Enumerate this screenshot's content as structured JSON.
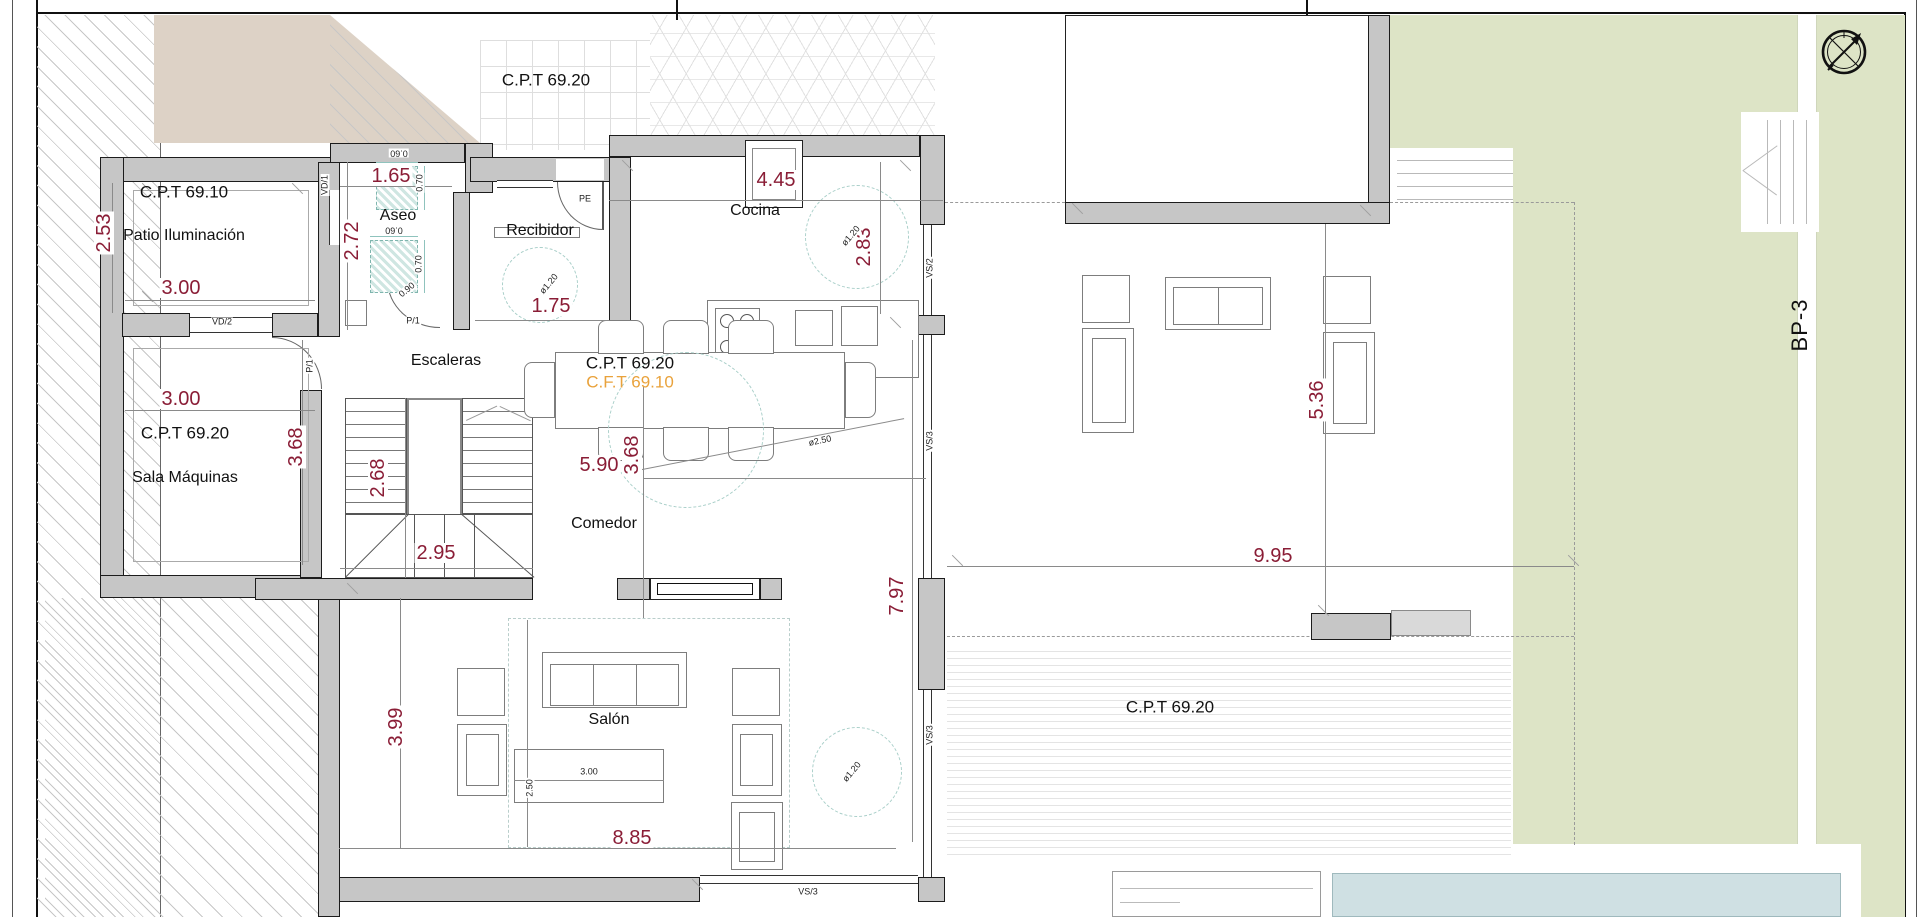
{
  "colors": {
    "wall_gray": "#c6c6c6",
    "dim_text": "#8a1d36",
    "accent_orange": "#e9a23b",
    "garden_green": "#dde4c6",
    "pool_blue": "#cfe0e3",
    "terrain_beige": "#ddd2c6",
    "fixture_teal": "#7fb5ae"
  },
  "rooms": [
    "Patio Iluminación",
    "Aseo",
    "Recibidor",
    "Escaleras",
    "Sala Máquinas",
    "Cocina",
    "Comedor",
    "Salón"
  ],
  "level_marks": [
    "C.P.T 69.20",
    "C.P.T 69.10",
    "C.F.T 69.10"
  ],
  "opening_codes": [
    "PE",
    "VD/1",
    "VD/2",
    "P/1",
    "VS/2",
    "VS/3"
  ],
  "path_label": "BP-3",
  "icons": [
    {
      "name": "compass-icon"
    }
  ],
  "labels": [
    {
      "text": "C.P.T 69.20",
      "x": 546,
      "y": 80,
      "r": 0,
      "cls": "site",
      "name": "level-mark-site"
    },
    {
      "text": "C.P.T 69.10",
      "x": 184,
      "y": 192,
      "r": 0,
      "cls": "site",
      "name": "level-mark-patio"
    },
    {
      "text": "Patio Iluminación",
      "x": 184,
      "y": 236,
      "r": 0,
      "cls": "room",
      "name": "room-label-patio"
    },
    {
      "text": "2.53",
      "x": 104,
      "y": 233,
      "r": -90,
      "cls": "dim",
      "name": "dim-patio-height"
    },
    {
      "text": "3.00",
      "x": 181,
      "y": 288,
      "r": 0,
      "cls": "dim",
      "name": "dim-patio-width"
    },
    {
      "text": "1.65",
      "x": 391,
      "y": 176,
      "r": 0,
      "cls": "dim",
      "name": "dim-aseo-width"
    },
    {
      "text": "2.72",
      "x": 352,
      "y": 241,
      "r": -90,
      "cls": "dim",
      "name": "dim-aseo-height"
    },
    {
      "text": "Aseo",
      "x": 398,
      "y": 216,
      "r": 0,
      "cls": "room",
      "name": "room-label-aseo"
    },
    {
      "text": "0.60",
      "x": 399,
      "y": 153,
      "r": 180,
      "cls": "tiny",
      "name": "dim-fixture"
    },
    {
      "text": "0.70",
      "x": 420,
      "y": 183,
      "r": -90,
      "cls": "tiny",
      "name": "dim-fixture"
    },
    {
      "text": "0.60",
      "x": 394,
      "y": 230,
      "r": 180,
      "cls": "tiny",
      "name": "dim-fixture"
    },
    {
      "text": "0.70",
      "x": 419,
      "y": 264,
      "r": -90,
      "cls": "tiny",
      "name": "dim-fixture"
    },
    {
      "text": "0.90",
      "x": 407,
      "y": 290,
      "r": -40,
      "cls": "tiny",
      "name": "dim-door"
    },
    {
      "text": "P/1",
      "x": 413,
      "y": 321,
      "r": 0,
      "cls": "tiny",
      "name": "door-code-aseo"
    },
    {
      "text": "VD/1",
      "x": 325,
      "y": 185,
      "r": -90,
      "cls": "tiny",
      "name": "window-code-vd1"
    },
    {
      "text": "VD/2",
      "x": 222,
      "y": 322,
      "r": 0,
      "cls": "tiny",
      "name": "window-code-vd2"
    },
    {
      "text": "Recibidor",
      "x": 540,
      "y": 231,
      "r": 0,
      "cls": "room",
      "name": "room-label-recibidor"
    },
    {
      "text": "1.75",
      "x": 551,
      "y": 306,
      "r": 0,
      "cls": "dim",
      "name": "dim-recibidor"
    },
    {
      "text": "PE",
      "x": 585,
      "y": 199,
      "r": 0,
      "cls": "tiny",
      "name": "door-code-pe"
    },
    {
      "text": "ø1.20",
      "x": 549,
      "y": 284,
      "r": -50,
      "cls": "tiny",
      "name": "dim-turning-circle"
    },
    {
      "text": "Cocina",
      "x": 755,
      "y": 211,
      "r": 0,
      "cls": "room",
      "name": "room-label-cocina"
    },
    {
      "text": "4.45",
      "x": 776,
      "y": 180,
      "r": 0,
      "cls": "dim",
      "name": "dim-cocina-width"
    },
    {
      "text": "2.83",
      "x": 864,
      "y": 247,
      "r": -90,
      "cls": "dim",
      "name": "dim-cocina-depth"
    },
    {
      "text": "ø1.20",
      "x": 851,
      "y": 236,
      "r": -50,
      "cls": "tiny",
      "name": "dim-turning-circle"
    },
    {
      "text": "VS/2",
      "x": 930,
      "y": 268,
      "r": -90,
      "cls": "tiny",
      "name": "window-code-vs2"
    },
    {
      "text": "Escaleras",
      "x": 446,
      "y": 361,
      "r": 0,
      "cls": "room",
      "name": "room-label-escaleras"
    },
    {
      "text": "C.P.T 69.20",
      "x": 630,
      "y": 363,
      "r": 0,
      "cls": "site",
      "name": "level-mark-interior"
    },
    {
      "text": "C.F.T 69.10",
      "x": 630,
      "y": 382,
      "r": 0,
      "cls": "site orange",
      "name": "level-mark-cft"
    },
    {
      "text": "P/1",
      "x": 310,
      "y": 366,
      "r": -90,
      "cls": "tiny",
      "name": "door-code-hall"
    },
    {
      "text": "3.00",
      "x": 181,
      "y": 399,
      "r": 0,
      "cls": "dim",
      "name": "dim-sala-width"
    },
    {
      "text": "C.P.T 69.20",
      "x": 185,
      "y": 433,
      "r": 0,
      "cls": "site",
      "name": "level-mark-sala"
    },
    {
      "text": "Sala Máquinas",
      "x": 185,
      "y": 478,
      "r": 0,
      "cls": "room",
      "name": "room-label-sala-maquinas"
    },
    {
      "text": "3.68",
      "x": 296,
      "y": 447,
      "r": -90,
      "cls": "dim",
      "name": "dim-sala-height"
    },
    {
      "text": "2.68",
      "x": 378,
      "y": 478,
      "r": -90,
      "cls": "dim",
      "name": "dim-stairs-height"
    },
    {
      "text": "2.95",
      "x": 436,
      "y": 553,
      "r": 0,
      "cls": "dim",
      "name": "dim-stairs-width"
    },
    {
      "text": "3.68",
      "x": 632,
      "y": 455,
      "r": -90,
      "cls": "dim",
      "name": "dim-comedor-left"
    },
    {
      "text": "5.90",
      "x": 599,
      "y": 465,
      "r": 0,
      "cls": "dim",
      "name": "dim-comedor-width"
    },
    {
      "text": "ø2.50",
      "x": 820,
      "y": 441,
      "r": -12,
      "cls": "tiny",
      "name": "dim-table-circle"
    },
    {
      "text": "Comedor",
      "x": 604,
      "y": 524,
      "r": 0,
      "cls": "room",
      "name": "room-label-comedor"
    },
    {
      "text": "VS/3",
      "x": 930,
      "y": 441,
      "r": -90,
      "cls": "tiny",
      "name": "window-code-vs3"
    },
    {
      "text": "7.97",
      "x": 897,
      "y": 596,
      "r": -90,
      "cls": "dim",
      "name": "dim-east-facade"
    },
    {
      "text": "VS/3",
      "x": 930,
      "y": 735,
      "r": -90,
      "cls": "tiny",
      "name": "window-code-vs3"
    },
    {
      "text": "3.99",
      "x": 396,
      "y": 727,
      "r": -90,
      "cls": "dim",
      "name": "dim-salon-height"
    },
    {
      "text": "Salón",
      "x": 609,
      "y": 720,
      "r": 0,
      "cls": "room",
      "name": "room-label-salon"
    },
    {
      "text": "2.50",
      "x": 530,
      "y": 788,
      "r": -90,
      "cls": "tiny",
      "name": "dim-sofa-zone"
    },
    {
      "text": "3.00",
      "x": 589,
      "y": 772,
      "r": 0,
      "cls": "tiny",
      "name": "dim-sofa-width"
    },
    {
      "text": "ø1.20",
      "x": 852,
      "y": 772,
      "r": -50,
      "cls": "tiny",
      "name": "dim-turning-circle"
    },
    {
      "text": "8.85",
      "x": 632,
      "y": 838,
      "r": 0,
      "cls": "dim",
      "name": "dim-salon-width"
    },
    {
      "text": "VS/3",
      "x": 808,
      "y": 892,
      "r": 0,
      "cls": "tiny",
      "name": "window-code-vs3"
    },
    {
      "text": "9.95",
      "x": 1273,
      "y": 556,
      "r": 0,
      "cls": "dim",
      "name": "dim-terrace-width"
    },
    {
      "text": "5.36",
      "x": 1317,
      "y": 400,
      "r": -90,
      "cls": "dim",
      "name": "dim-terrace-depth"
    },
    {
      "text": "C.P.T 69.20",
      "x": 1170,
      "y": 707,
      "r": 0,
      "cls": "site",
      "name": "level-mark-terrace"
    },
    {
      "text": "BP-3",
      "x": 1800,
      "y": 325,
      "r": -90,
      "cls": "bp",
      "name": "path-label-bp3"
    }
  ],
  "dim_lines": [
    {
      "x": 112,
      "y": 183,
      "w": 1,
      "h": 130
    },
    {
      "x": 125,
      "y": 300,
      "w": 190,
      "h": 1
    },
    {
      "x": 340,
      "y": 186,
      "w": 112,
      "h": 1
    },
    {
      "x": 347,
      "y": 162,
      "w": 1,
      "h": 168
    },
    {
      "x": 475,
      "y": 320,
      "w": 134,
      "h": 1
    },
    {
      "x": 609,
      "y": 200,
      "w": 334,
      "h": 1
    },
    {
      "x": 880,
      "y": 162,
      "w": 1,
      "h": 152
    },
    {
      "x": 125,
      "y": 410,
      "w": 190,
      "h": 1
    },
    {
      "x": 302,
      "y": 340,
      "w": 1,
      "h": 225
    },
    {
      "x": 405,
      "y": 398,
      "w": 1,
      "h": 180
    },
    {
      "x": 340,
      "y": 568,
      "w": 193,
      "h": 1
    },
    {
      "x": 643,
      "y": 386,
      "w": 1,
      "h": 232
    },
    {
      "x": 643,
      "y": 478,
      "w": 283,
      "h": 1
    },
    {
      "x": 400,
      "y": 598,
      "w": 1,
      "h": 250
    },
    {
      "x": 339,
      "y": 848,
      "w": 557,
      "h": 1
    },
    {
      "x": 912,
      "y": 340,
      "w": 1,
      "h": 502
    },
    {
      "x": 947,
      "y": 566,
      "w": 627,
      "h": 1
    },
    {
      "x": 1325,
      "y": 224,
      "w": 1,
      "h": 390
    },
    {
      "x": 637,
      "y": 470,
      "w": 272,
      "h": 1,
      "r": -11
    },
    {
      "x": 527,
      "y": 620,
      "w": 1,
      "h": 227
    },
    {
      "x": 514,
      "y": 780,
      "w": 150,
      "h": 1
    },
    {
      "x": 376,
      "y": 162,
      "w": 42,
      "h": 1,
      "teal": true
    },
    {
      "x": 424,
      "y": 166,
      "w": 1,
      "h": 44,
      "teal": true
    },
    {
      "x": 370,
      "y": 236,
      "w": 48,
      "h": 1,
      "teal": true
    },
    {
      "x": 424,
      "y": 240,
      "w": 1,
      "h": 53,
      "teal": true
    }
  ]
}
